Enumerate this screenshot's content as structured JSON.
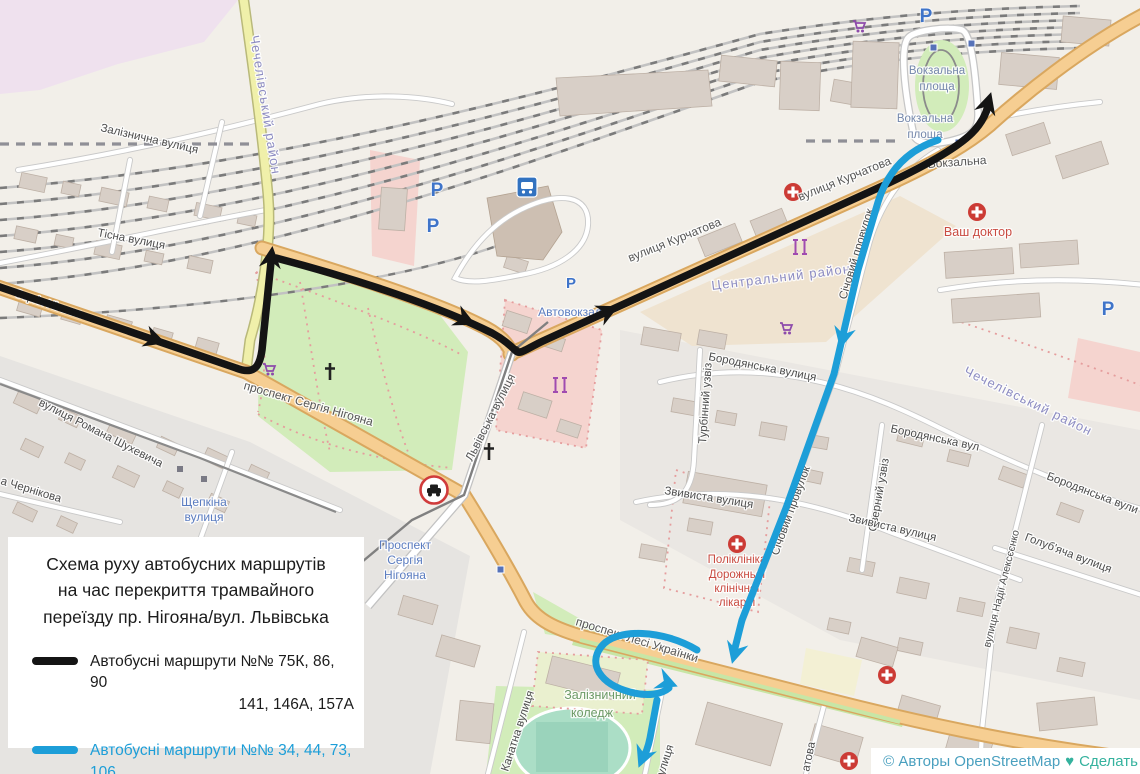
{
  "colors": {
    "route_black": "#141414",
    "route_blue": "#1d9ed8",
    "map_background": "#f2efe9"
  },
  "legend": {
    "title_lines": [
      "Схема руху автобусних маршрутів",
      "на час перекриття трамвайного",
      "переїзду пр. Нігояна/вул. Львівська"
    ],
    "items": [
      {
        "color": "#141414",
        "line1": "Автобусні маршрути №№ 75К, 86, 90",
        "line2": "141, 146А, 157А"
      },
      {
        "color": "#1d9ed8",
        "line1": "Автобусні маршрути №№ 34, 44, 73, 106",
        "line2": ""
      }
    ]
  },
  "attribution": {
    "copyright": "© Авторы OpenStreetMap",
    "heart": "♥",
    "link_text": "Сделать"
  },
  "icons": {
    "parking_letter": "P"
  },
  "map_labels": {
    "zaliznychna": "Залізнична вулиця",
    "tisna": "Тісна вулиця",
    "serhiya_nihoyana": "Сергія Нігояна",
    "prospekt_nihoyana": "проспект Сергія Нігояна",
    "shukhevycha": "вулиця Романа Шухевича",
    "chernikova": "а Чернікова",
    "shchepkina_l1": "Щепкіна",
    "shchepkina_l2": "вулиця",
    "lvivska": "Львівська вулиця",
    "avtovokzal": "Автовокзал",
    "kurchatova_1": "вулиця Курчатова",
    "kurchatova_2": "вулиця Курчатова",
    "vokzalna_pl_a1": "Вокзальна",
    "vokzalna_pl_a2": "площа",
    "vokzalna_pl_b1": "Вокзальна",
    "vokzalna_pl_b2": "площа",
    "vokzalna_street": "Вокзальна",
    "tsentralnyi_raion": "Центральний район",
    "chechelivskyi_raion_1": "Чечелівський район",
    "chechelivskyi_raion_2": "Чечелівський район",
    "vash_doktor": "Ваш доктор",
    "borodyanska_1": "Бородянська вулиця",
    "borodyanska_2": "Бородянська вул",
    "borodyanska_3": "Бородянська вули",
    "holubyacha": "Голуб'яча вулиця",
    "nadii_alekseenko": "вулиця Надії Алексєєнко",
    "turbinnyi": "Турбінний узвіз",
    "ozernyi": "Озерний узвіз",
    "zvyvysta_1": "Звивиста вулиця",
    "zvyvysta_2": "Звивиста вулиця",
    "sichovyi_1": "Січовий провулок",
    "sichovyi_2": "Січовий провулок",
    "poliklinika_l1": "Поліклініка",
    "poliklinika_l2": "Дорожньої",
    "poliklinika_l3": "клінічної",
    "poliklinika_l4": "лікарні",
    "lesi_ukrainky": "проспект Лесі Українки",
    "koledzh_l1": "Залізничний",
    "koledzh_l2": "коледж",
    "kanatna": "Канатна вулиця",
    "stop_nihoyana_l1": "Проспект",
    "stop_nihoyana_l2": "Сергія",
    "stop_nihoyana_l3": "Нігояна",
    "partial_ulytsya": "улиця",
    "partial_atova": "атова"
  }
}
